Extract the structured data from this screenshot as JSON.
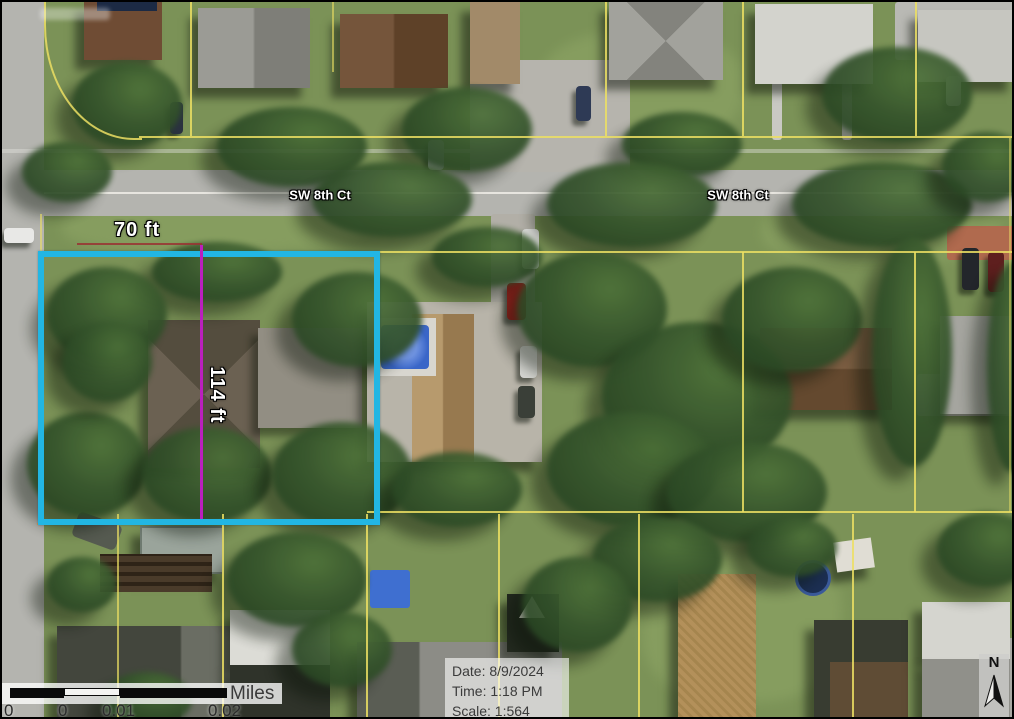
{
  "map": {
    "street_label_west": "SW 8th Ct",
    "street_label_east": "SW 8th Ct",
    "parcel_width_label": "70 ft",
    "parcel_depth_label": "114 ft"
  },
  "scale_bar": {
    "unit": "Miles",
    "ticks": [
      "0",
      "0",
      "0.01",
      "0.02"
    ]
  },
  "info_box": {
    "date": "Date: 8/9/2024",
    "time": "Time: 1:18 PM",
    "scale": "Scale: 1:564"
  },
  "north_arrow": {
    "label": "N"
  },
  "colors": {
    "highlight_cyan": "#22b6e3",
    "lot_split_magenta": "#bb1fbe",
    "parcel_line_yellow": "#ecdf63",
    "measure_red": "#993333",
    "road_gray": "#b4b4af"
  }
}
